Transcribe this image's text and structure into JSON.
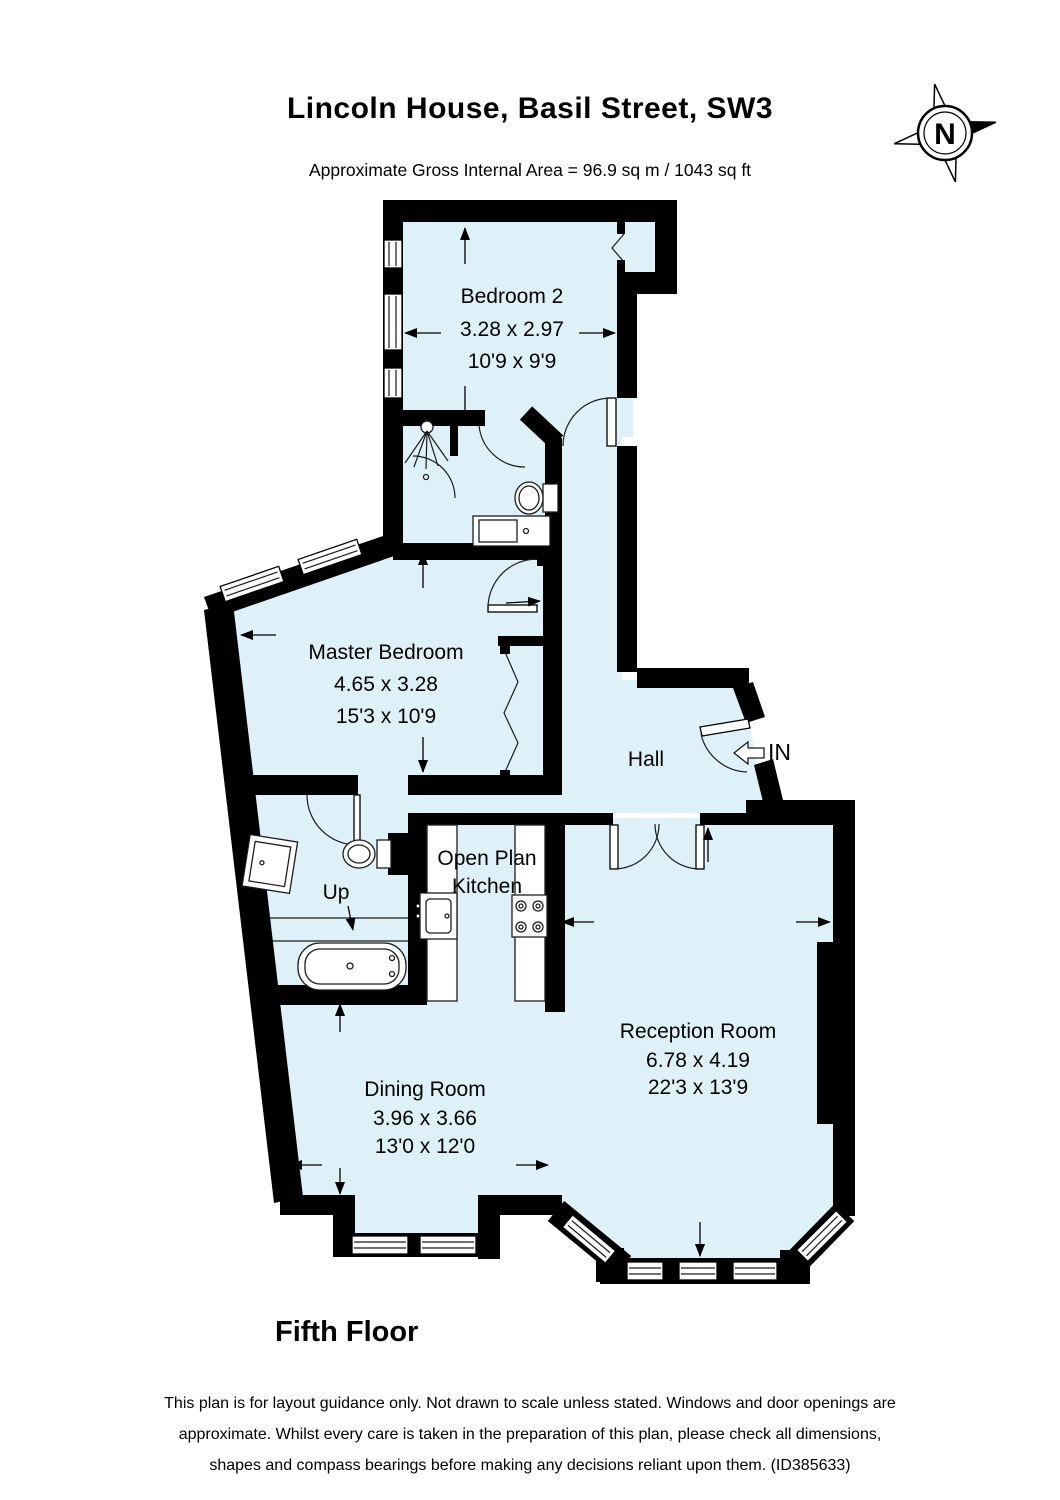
{
  "header": {
    "title": "Lincoln House, Basil Street, SW3",
    "area_line": "Approximate Gross Internal Area =  96.9 sq m / 1043 sq ft"
  },
  "compass": {
    "north_label": "N"
  },
  "rooms": {
    "bedroom2": {
      "name": "Bedroom 2",
      "metric": "3.28 x 2.97",
      "imperial": "10'9 x 9'9"
    },
    "master_bedroom": {
      "name": "Master Bedroom",
      "metric": "4.65 x 3.28",
      "imperial": "15'3 x 10'9"
    },
    "hall": {
      "name": "Hall"
    },
    "kitchen": {
      "line1": "Open Plan",
      "line2": "Kitchen"
    },
    "reception": {
      "name": "Reception Room",
      "metric": "6.78 x 4.19",
      "imperial": "22'3 x 13'9"
    },
    "dining": {
      "name": "Dining Room",
      "metric": "3.96 x 3.66",
      "imperial": "13'0 x 12'0"
    }
  },
  "annotations": {
    "entrance": "IN",
    "stairs": "Up"
  },
  "footer": {
    "floor_name": "Fifth Floor",
    "disclaimer": "This plan is for layout guidance only. Not drawn to scale unless stated. Windows and door openings are approximate. Whilst every care is taken in the preparation of this plan, please check all dimensions, shapes and compass bearings before making any decisions reliant upon them. (ID385633)"
  },
  "colors": {
    "floor_fill": "#dff1f8",
    "wall": "#000000",
    "fixture_stroke": "#1c1c1c"
  }
}
